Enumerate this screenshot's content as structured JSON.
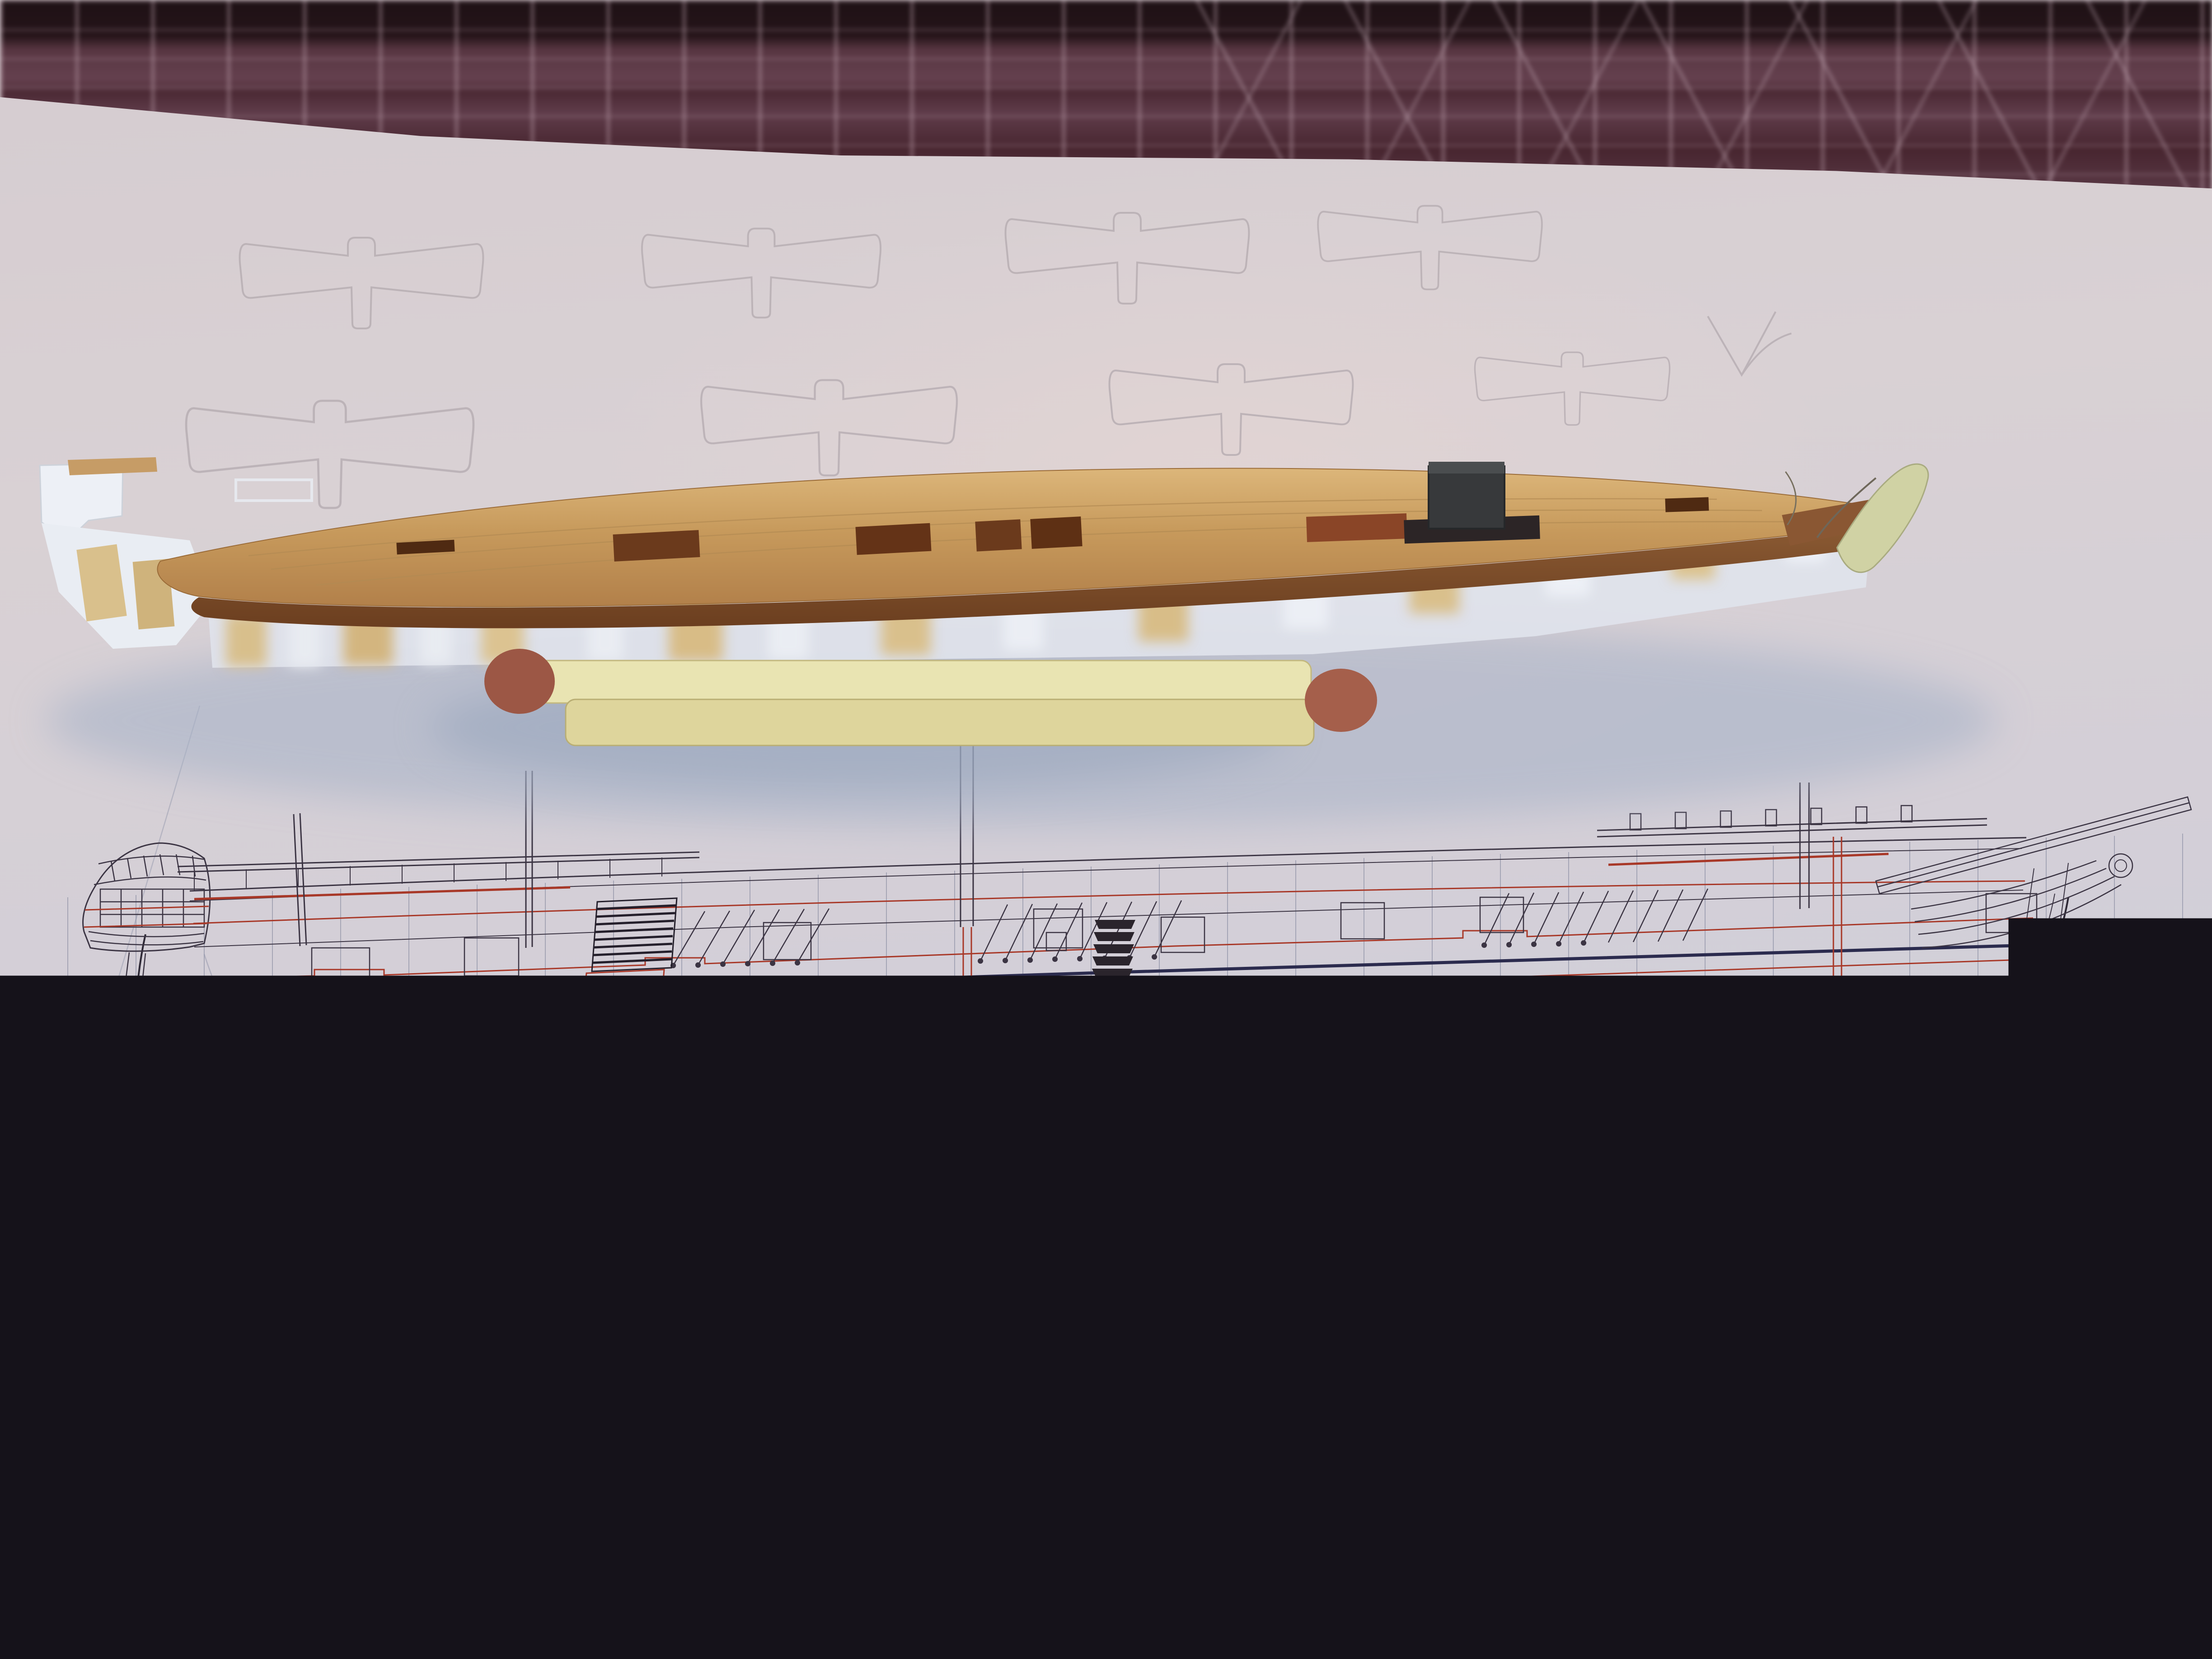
{
  "plan": {
    "length_label": "141' 5½\" (= 43,12m)",
    "bow_angle_label": "0.25°",
    "stations": [
      "31",
      "29",
      "27",
      "25",
      "23",
      "21",
      "19",
      "17",
      "15",
      "13",
      "11",
      "9",
      "7",
      "5",
      "3",
      "1",
      "⊕",
      "(B)",
      "B",
      "D",
      "F",
      "H",
      "K",
      "M",
      "O",
      "Q",
      "S",
      "U",
      "X",
      "Z",
      "b",
      "d"
    ],
    "feet_labels": [
      "5'",
      "10'",
      "20'",
      "30'",
      "40'",
      "50'",
      "60'",
      "70'",
      "80'",
      "90'",
      "100'",
      "10'",
      "20'",
      "30'",
      "40'"
    ],
    "meter_scale_numbers": [
      "1",
      "2",
      "3",
      "4",
      "5",
      "6",
      "7",
      "8",
      "9",
      "10",
      "11",
      "12"
    ]
  },
  "colors": {
    "plan_red": "#a83828",
    "plan_ink": "#3b3443",
    "waterline_navy": "#2b2b4e",
    "scale_bar_black": "#241e28",
    "mat_purple": "#5b3a47",
    "paper": "#d6cdd1",
    "deck_wood": "#c79a5c",
    "hull_burnt_edge": "#7c4a27",
    "matchstick": "#e9e4b2",
    "match_head": "#9c5745",
    "card_white": "#eceff5",
    "stem_piece_green": "#d0d2a4"
  }
}
